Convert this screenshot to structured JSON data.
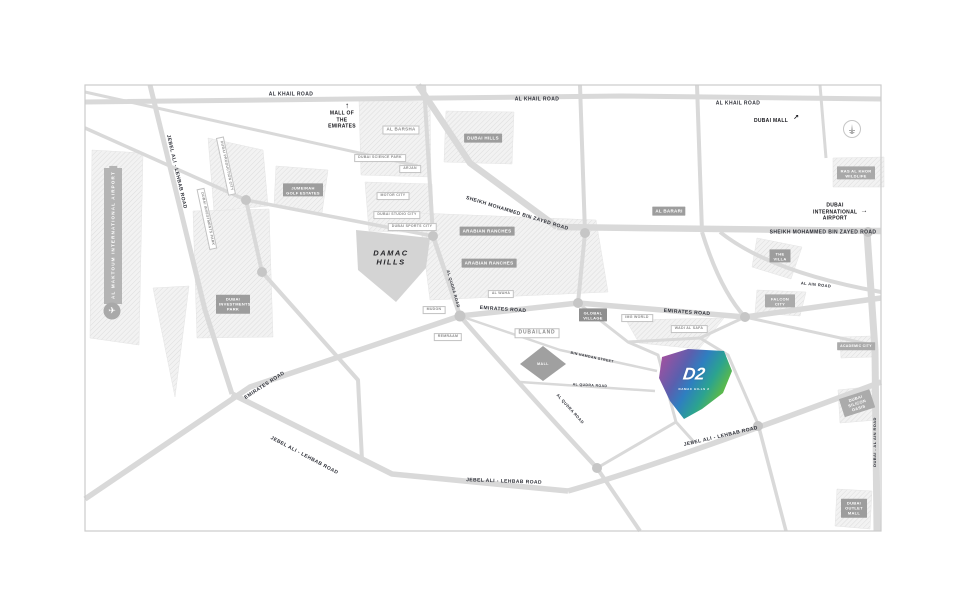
{
  "roads": {
    "al_khail": "AL KHAIL ROAD",
    "smbz": "SHEIKH MOHAMMED BIN ZAYED ROAD",
    "emirates": "EMIRATES ROAD",
    "jebel_ali_lehbab": "JEBEL ALI - LEHBAB ROAD",
    "al_qudra": "AL QUDRA ROAD",
    "al_ain": "AL AIN ROAD",
    "dubai_al_ain": "DUBAI - AL AIN ROAD",
    "bin_hamdan": "BIN HAMDAN STREET"
  },
  "areas": {
    "jumeirah_golf_estates": "JUMEIRAH GOLF ESTATES",
    "dubai_hills": "DUBAI HILLS",
    "arabian_ranches": "ARABIAN RANCHES",
    "al_barari": "AL BARARI",
    "dubai_investments_park": "DUBAI INVESTMENTS PARK",
    "ras_al_khor": "RAS AL KHOR WILDLIFE",
    "global_village": "GLOBAL VILLAGE",
    "the_villa": "THE VILLA",
    "falcon_city": "FALCON CITY",
    "academic_city": "ACADEMIC CITY",
    "silicon_oasis": "DUBAI SILICON OASIS",
    "outlet_mall": "DUBAI OUTLET MALL"
  },
  "communities": {
    "al_barsha": "AL BARSHA",
    "dubailand": "DUBAILAND",
    "mudon": "MUDON",
    "remraam": "REMRAAM",
    "al_waha": "AL WAHA",
    "img_world": "IMG WORLD",
    "wadi_al_safa": "WADI AL SAFA",
    "science_park": "DUBAI SCIENCE PARK",
    "arjan": "ARJAN",
    "motor_city": "MOTOR CITY",
    "studio_city": "DUBAI STUDIO CITY",
    "sports_city": "DUBAI SPORTS CITY",
    "production_city": "DUBAI PRODUCTION CITY"
  },
  "landmarks": {
    "mall_of_the_emirates": "MALL OF THE EMIRATES",
    "dubai_mall": "DUBAI MALL",
    "dubai_international_airport": "DUBAI INTERNATIONAL AIRPORT",
    "al_maktoum_airport": "AL MAKTOUM INTERNATIONAL AIRPORT",
    "mall": "MALL",
    "damac_hills": "DAMAC HILLS"
  },
  "d2": {
    "logo": "D2",
    "subtitle": "DAMAC HILLS 2"
  },
  "icons": {
    "arrow_up": "↑",
    "arrow_up_right": "↗",
    "arrow_right": "→",
    "plane": "✈"
  },
  "colors": {
    "road": "#d9d9d9",
    "label_box": "#9d9d9d",
    "d2_purple": "#a4509f",
    "d2_blue": "#2e7fc0",
    "d2_teal": "#2ba390",
    "d2_green": "#6cbf44"
  }
}
